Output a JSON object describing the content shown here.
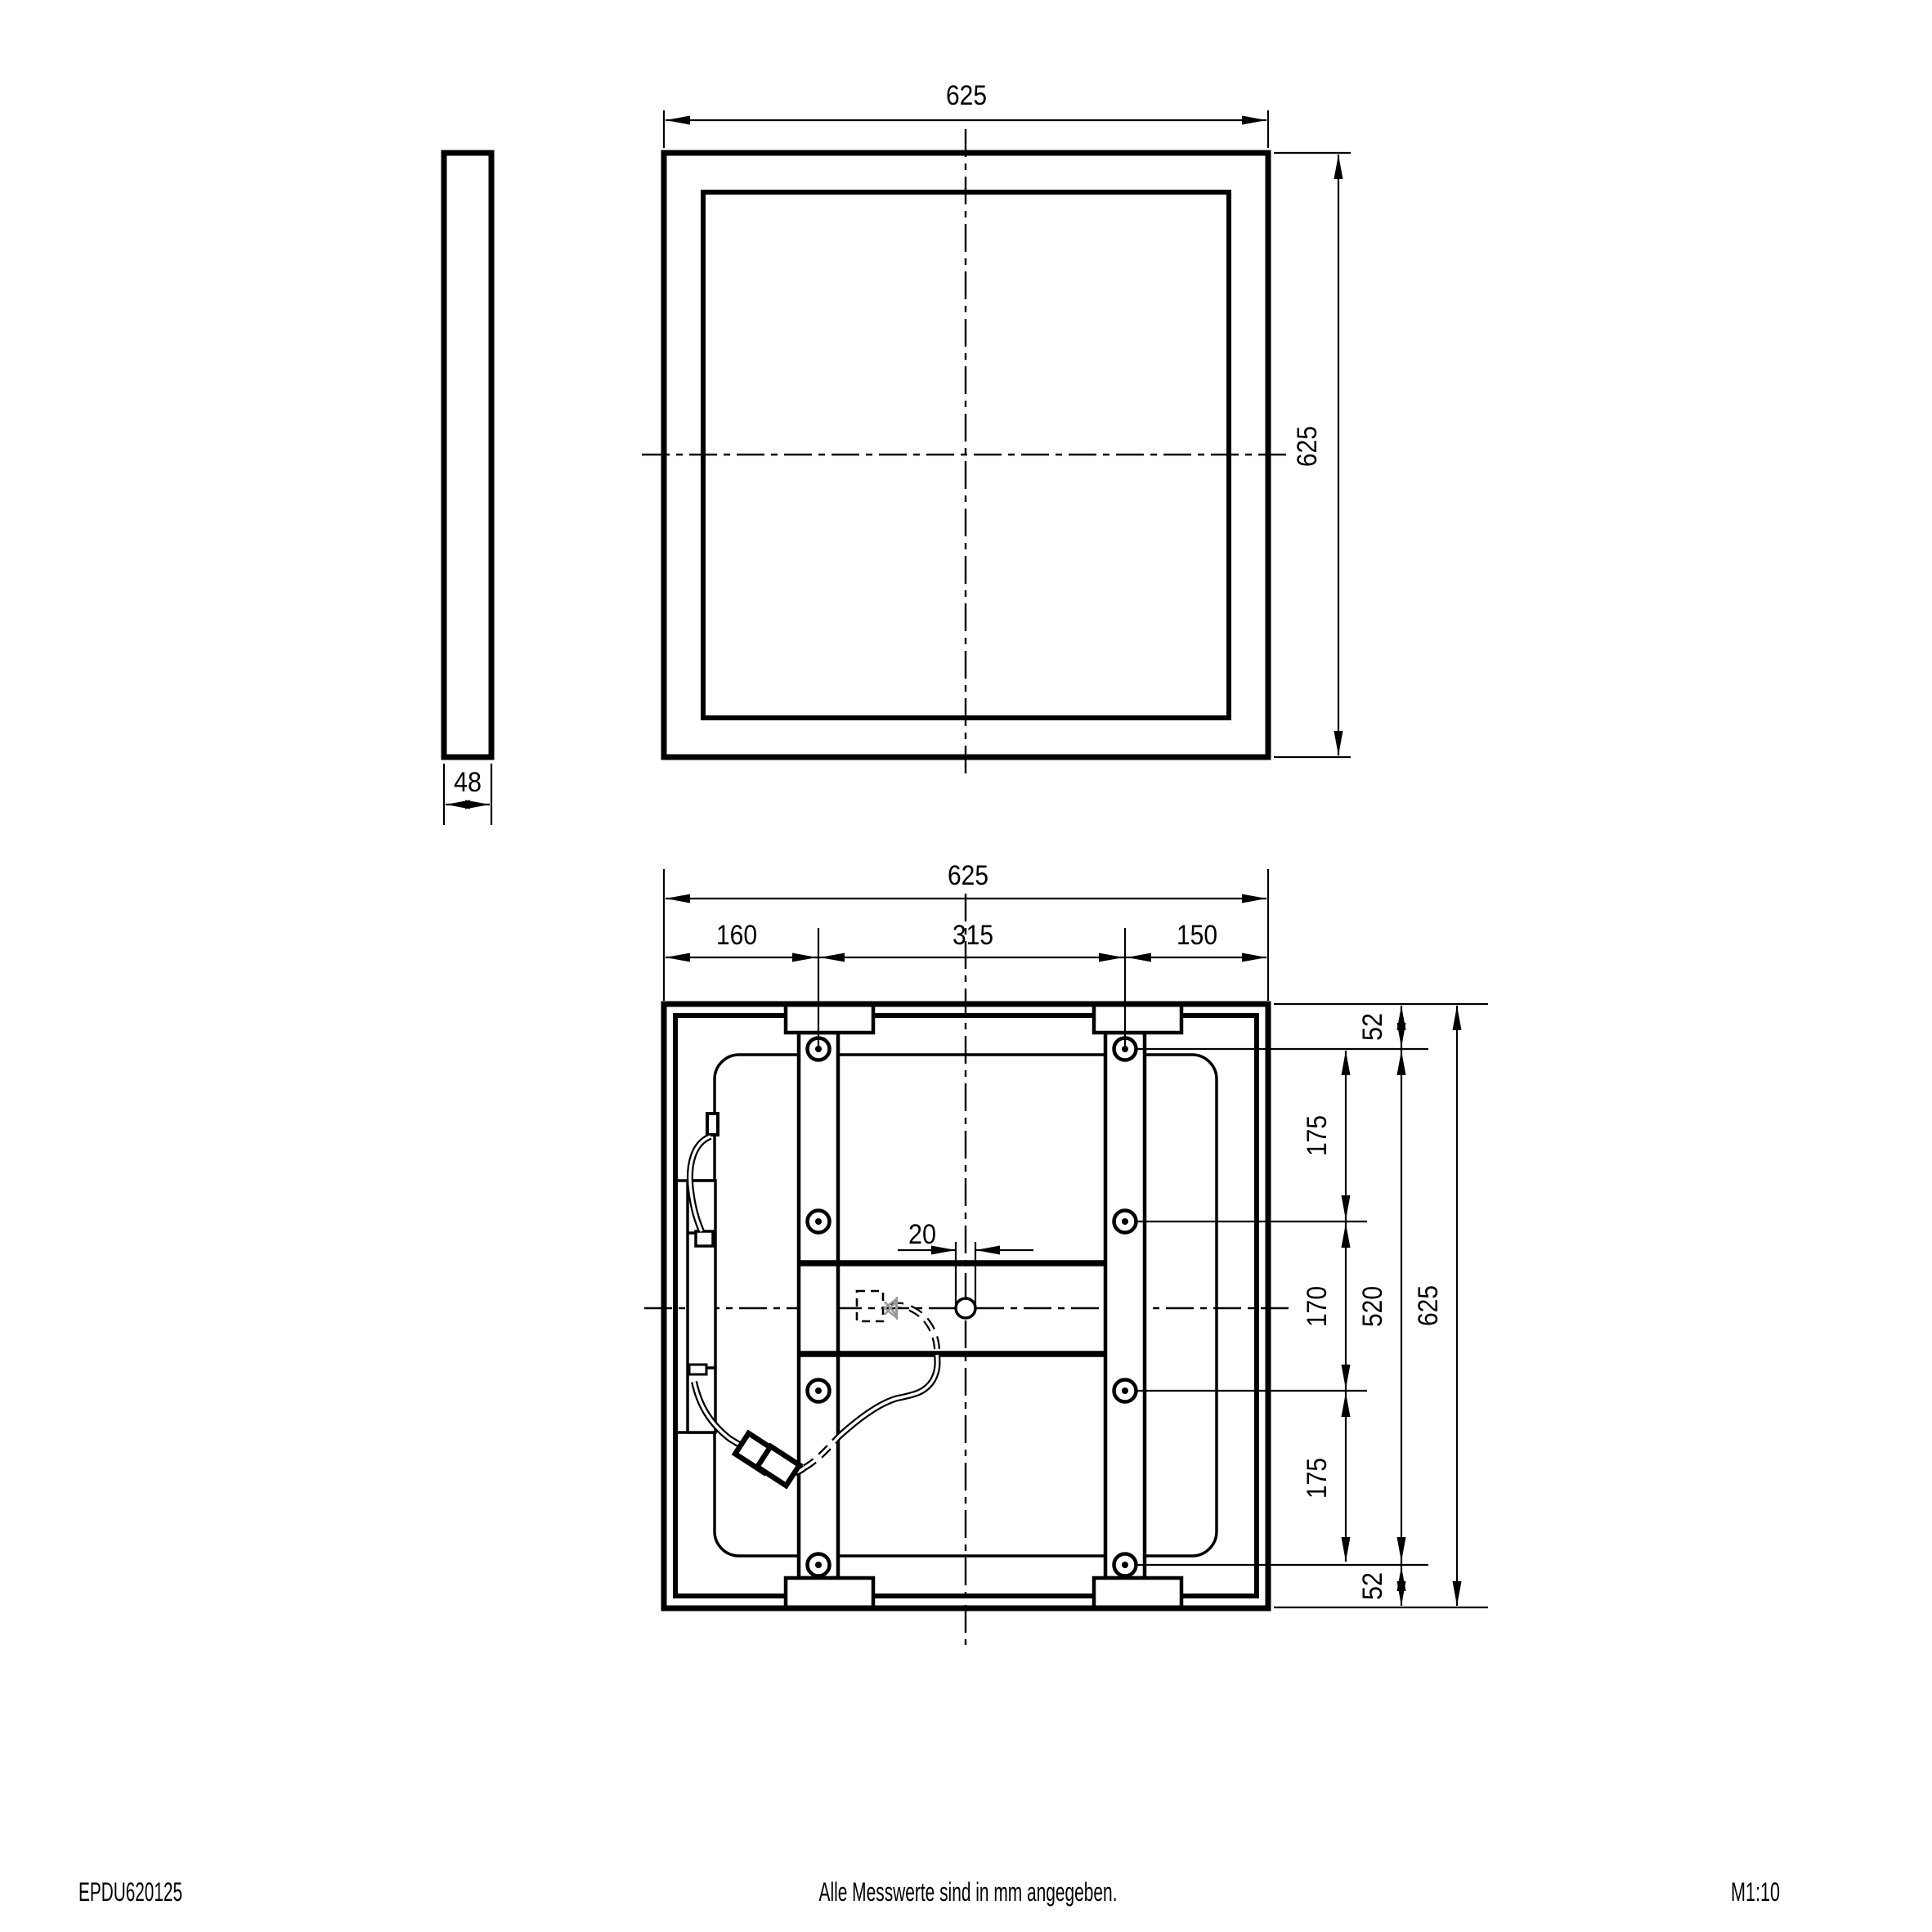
{
  "drawing": {
    "type": "technical-dimension-drawing",
    "units_note": "Alle Messwerte sind in mm angegeben.",
    "part_number": "EPDU620125",
    "scale": "M1:10",
    "line_color": "#000000",
    "hidden_accent_color": "#999999",
    "views": {
      "side_view": {
        "thickness": "48"
      },
      "front_view": {
        "width": "625",
        "height": "625"
      },
      "bottom_view": {
        "width": "625",
        "top_segments": {
          "left": "160",
          "middle": "315",
          "right": "150"
        },
        "cable_hole_diameter": "20",
        "right_chain": {
          "top_margin": "52",
          "upper_span": "175",
          "middle_span": "170",
          "lower_span": "175",
          "bottom_margin": "52",
          "hole_span": "520",
          "total_height": "625"
        }
      }
    }
  }
}
